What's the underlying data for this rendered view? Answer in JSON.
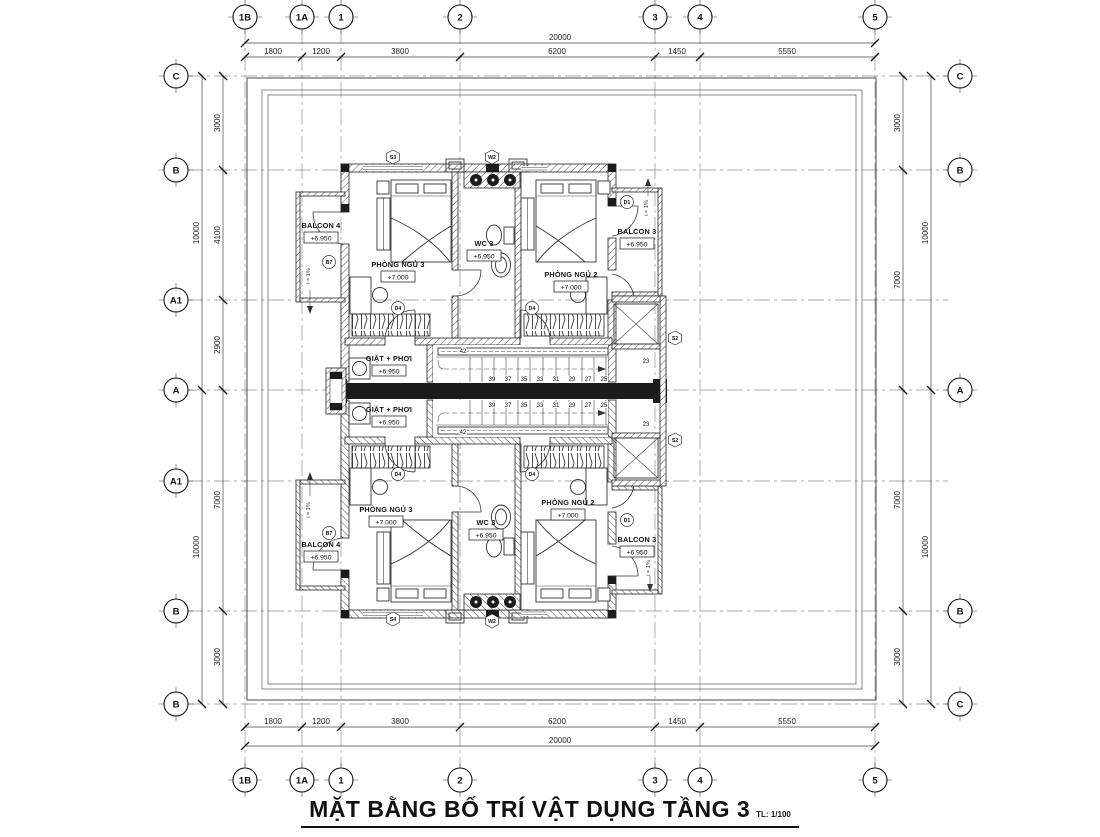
{
  "title": {
    "text": "MẶT BẰNG BỐ TRÍ VẬT DỤNG TẦNG 3",
    "scale": "TL: 1/100"
  },
  "grid": {
    "cols": [
      "1B",
      "1A",
      "1",
      "2",
      "3",
      "4",
      "5"
    ],
    "rows_left": [
      "C",
      "B",
      "A1",
      "A",
      "A1",
      "B",
      "B"
    ],
    "rows_right": [
      "C",
      "B",
      "A",
      "B",
      "C"
    ]
  },
  "dims": {
    "h_segments": [
      "1800",
      "1200",
      "3800",
      "6200",
      "1450",
      "5550"
    ],
    "h_total": "20000",
    "v_left_segments": [
      "3000",
      "4100",
      "2900",
      "7000",
      "3000"
    ],
    "v_left_totals": [
      "10000",
      "10000"
    ],
    "v_right_segments": [
      "3000",
      "7000",
      "7000",
      "3000"
    ],
    "v_right_totals": [
      "10000",
      "10000"
    ]
  },
  "rooms": {
    "balcon4": {
      "name": "BALCON 4",
      "level": "+6.950"
    },
    "balcon3": {
      "name": "BALCON 3",
      "level": "+6.950"
    },
    "bedroom3": {
      "name": "PHÒNG NGỦ 3",
      "level": "+7.000"
    },
    "bedroom2": {
      "name": "PHÒNG NGỦ 2",
      "level": "+7.000"
    },
    "wc3": {
      "name": "WC 3",
      "level": "+6.950"
    },
    "laundry": {
      "name": "GIẶT + PHƠI",
      "level": "+6.950"
    }
  },
  "tags": {
    "s2": "S2",
    "s3": "S3",
    "s4": "S4",
    "w2": "W2",
    "d4": "D4",
    "d1": "D1",
    "b7": "B7"
  },
  "stairs": {
    "numbers": [
      "39",
      "37",
      "35",
      "33",
      "31",
      "29",
      "27",
      "25"
    ],
    "landing": "23",
    "top_step": "42"
  },
  "annotations": {
    "slope": "i = 1%"
  }
}
